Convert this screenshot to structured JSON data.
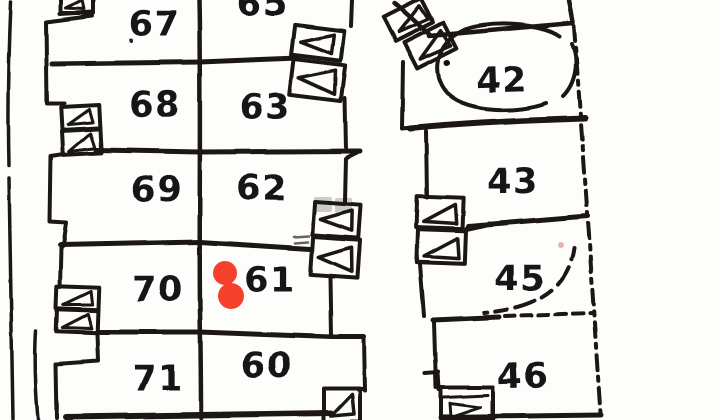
{
  "map": {
    "paper_color": "#fdfdfc",
    "ink_color": "#1a1814",
    "west_building": {
      "left_column_units": [
        "67",
        "68",
        "69",
        "70",
        "71"
      ],
      "right_column_units": [
        "65",
        "63",
        "62",
        "61",
        "60"
      ]
    },
    "east_building": {
      "units": [
        "42",
        "43",
        "45",
        "46"
      ]
    },
    "labels": {
      "u67": "67",
      "u68": "68",
      "u69": "69",
      "u70": "70",
      "u71": "71",
      "u65": "65",
      "u63": "63",
      "u62": "62",
      "u61": "61",
      "u60": "60",
      "u42": "42",
      "u43": "43",
      "u45": "45",
      "u46": "46"
    },
    "marker": {
      "color": "#f5402c",
      "style": "two-overlapping-dots",
      "next_to_unit": "61"
    },
    "annotations": {
      "hand_circle_around_unit": "42",
      "hand_arc_near_unit": "45"
    },
    "smudge_color": "#9a9a98"
  }
}
